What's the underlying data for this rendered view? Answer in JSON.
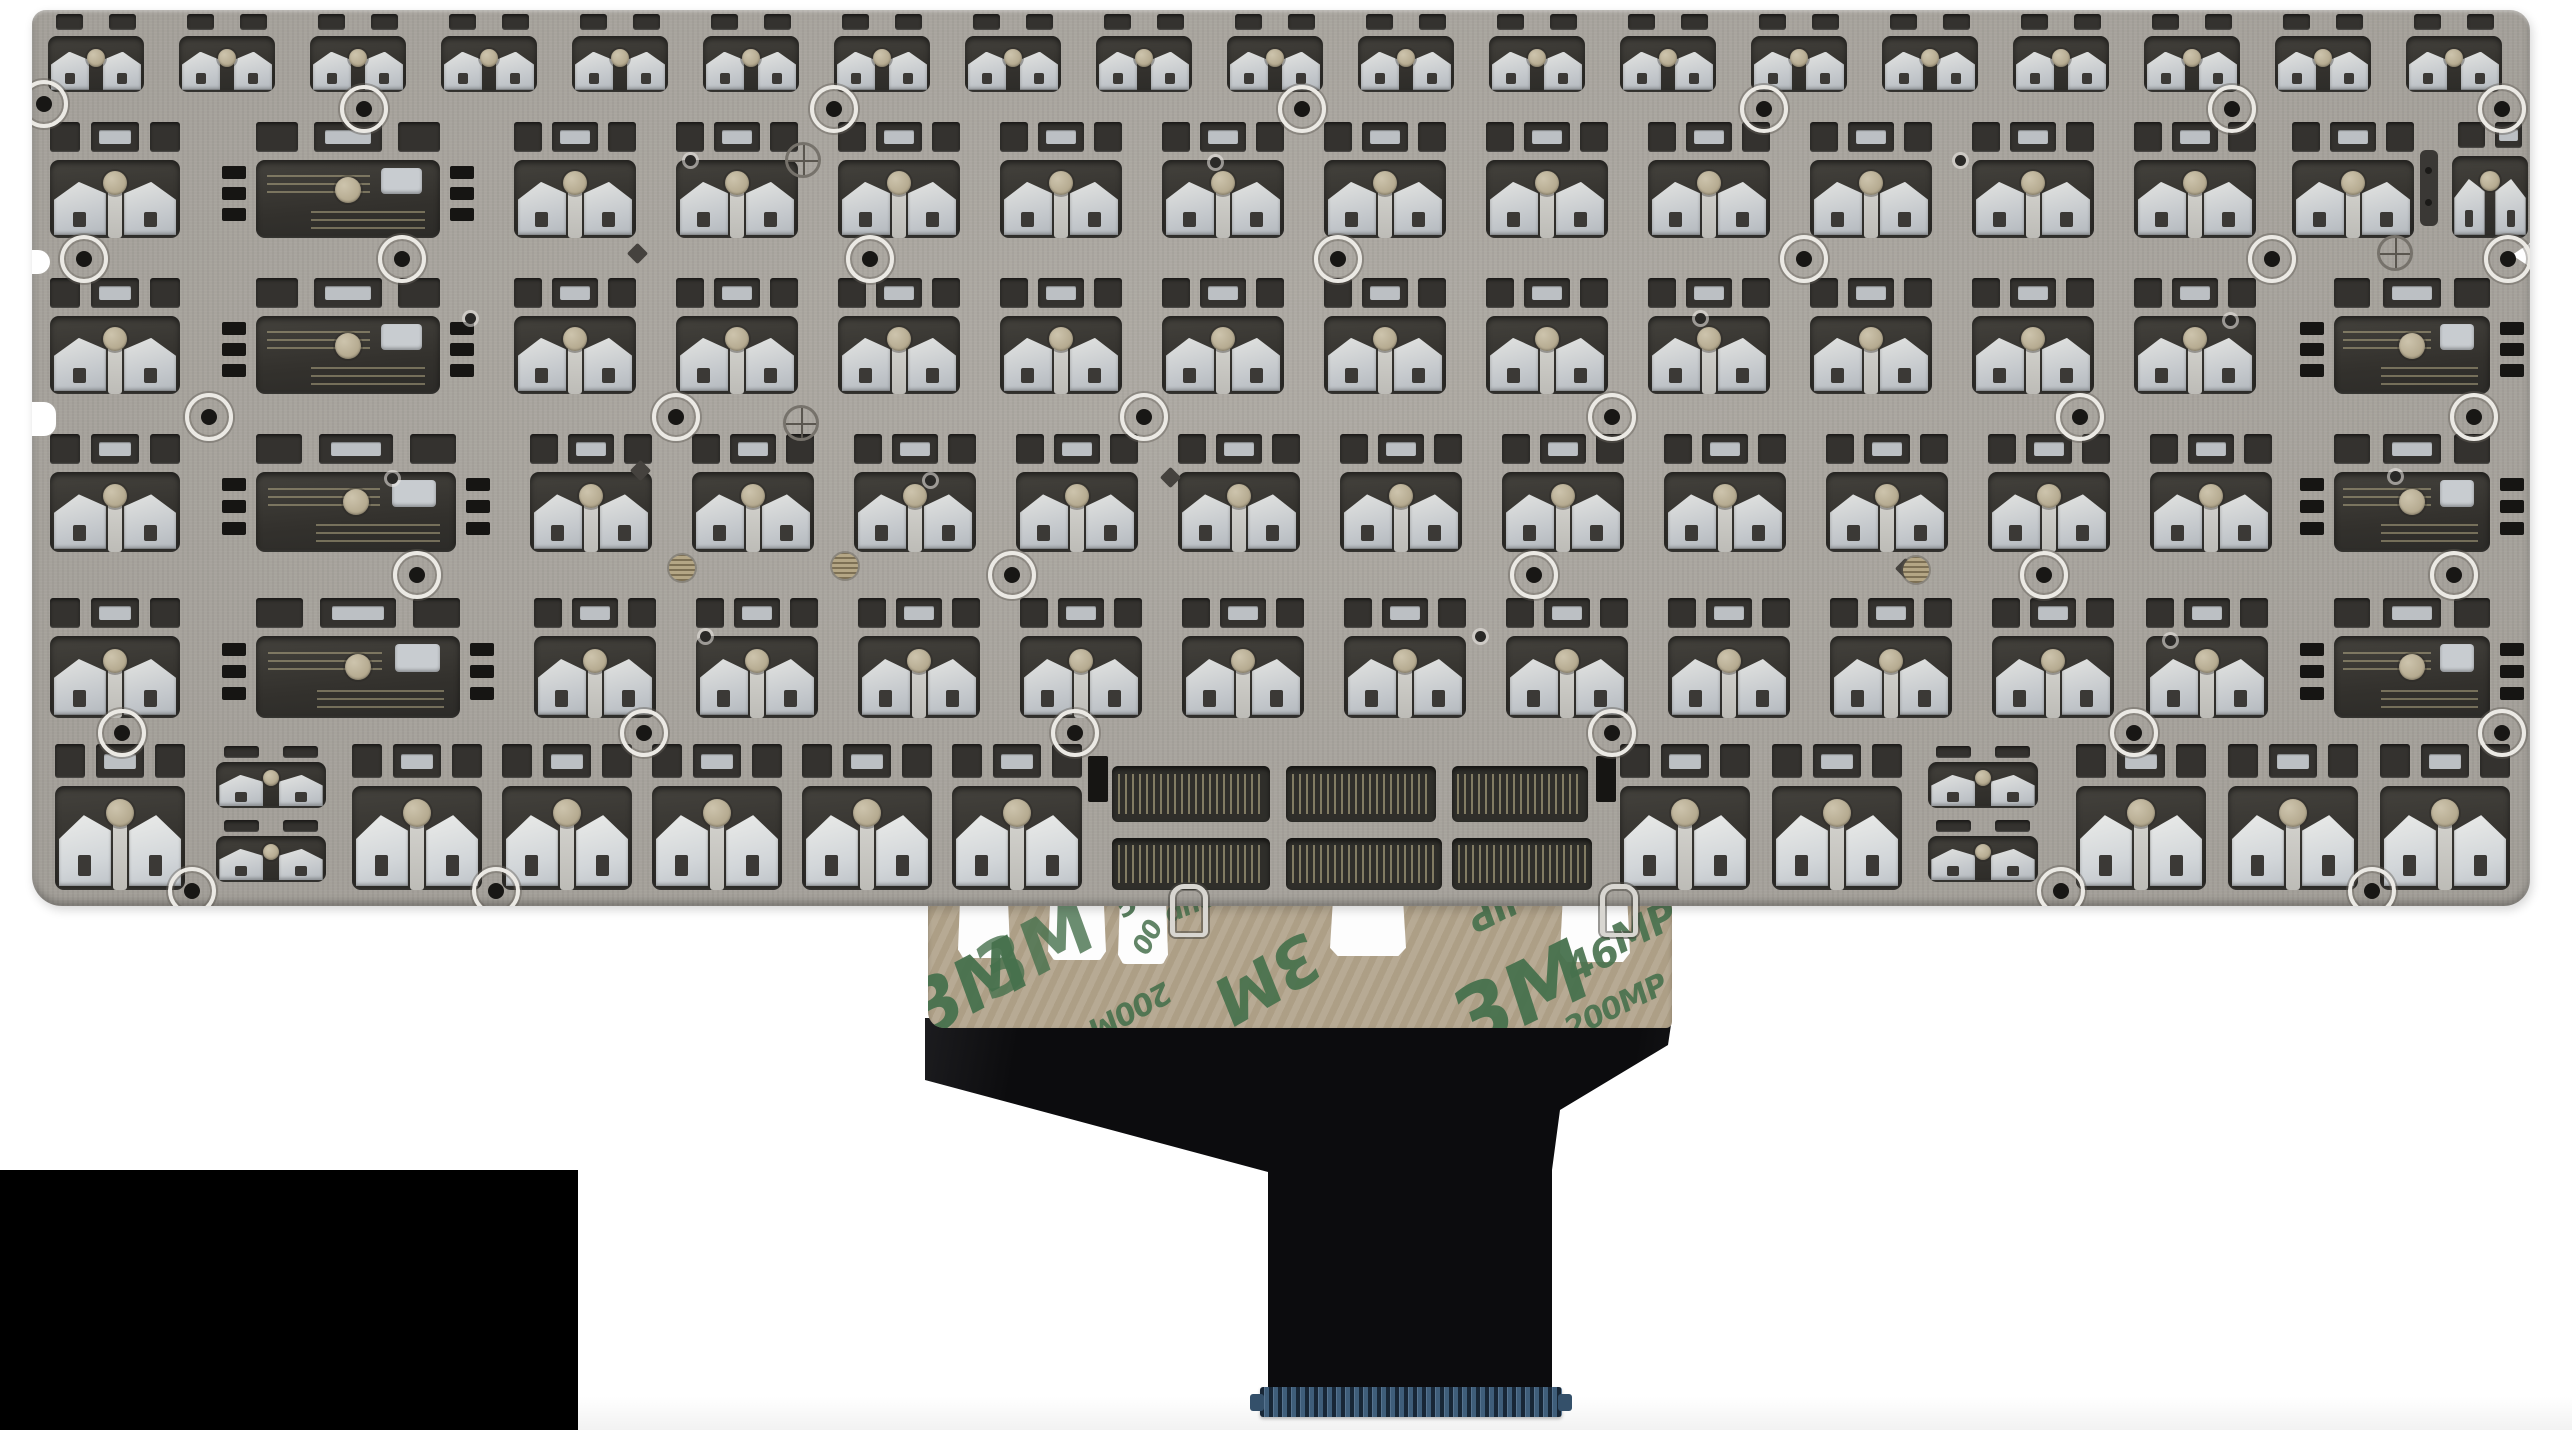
{
  "photo": {
    "canvas": {
      "w": 2572,
      "h": 1430,
      "background": "#ffffff"
    },
    "plate": {
      "x": 32,
      "y": 10,
      "w": 2498,
      "h": 896,
      "radius": "14px 20px 26px 30px",
      "edge_notches": [
        {
          "x": 24,
          "y": 250,
          "w": 26,
          "h": 24
        },
        {
          "x": 24,
          "y": 402,
          "w": 32,
          "h": 34
        }
      ],
      "right_wedge": {
        "x": 2512,
        "y": 243,
        "w": 18,
        "h": 24
      }
    },
    "rows": [
      {
        "y": 14,
        "h": 78,
        "segments": [
          {
            "t": "run",
            "k": "small",
            "x": 48,
            "w": 96,
            "gap": 35,
            "n": 19
          }
        ]
      },
      {
        "y": 122,
        "h": 116,
        "segments": [
          {
            "t": "one",
            "k": "std",
            "x": 50,
            "w": 130
          },
          {
            "t": "one",
            "k": "wide",
            "x": 222,
            "w": 252
          },
          {
            "t": "run",
            "k": "std",
            "x": 514,
            "w": 122,
            "gap": 40,
            "n": 11
          },
          {
            "t": "one",
            "k": "std",
            "x": 2292,
            "w": 122
          },
          {
            "t": "one",
            "k": "bracket",
            "x": 2420,
            "w": 18
          },
          {
            "t": "one",
            "k": "narrow",
            "x": 2452,
            "w": 76
          }
        ]
      },
      {
        "y": 278,
        "h": 116,
        "segments": [
          {
            "t": "one",
            "k": "std",
            "x": 50,
            "w": 130
          },
          {
            "t": "one",
            "k": "wide",
            "x": 222,
            "w": 252
          },
          {
            "t": "run",
            "k": "std",
            "x": 514,
            "w": 122,
            "gap": 40,
            "n": 11
          },
          {
            "t": "one",
            "k": "wide",
            "x": 2300,
            "w": 224
          }
        ]
      },
      {
        "y": 434,
        "h": 118,
        "segments": [
          {
            "t": "one",
            "k": "std",
            "x": 50,
            "w": 130
          },
          {
            "t": "one",
            "k": "wide",
            "x": 222,
            "w": 268
          },
          {
            "t": "run",
            "k": "std",
            "x": 530,
            "w": 122,
            "gap": 40,
            "n": 11
          },
          {
            "t": "one",
            "k": "wide",
            "x": 2300,
            "w": 224
          }
        ]
      },
      {
        "y": 598,
        "h": 120,
        "segments": [
          {
            "t": "one",
            "k": "std",
            "x": 50,
            "w": 130
          },
          {
            "t": "one",
            "k": "wide",
            "x": 222,
            "w": 272
          },
          {
            "t": "run",
            "k": "std",
            "x": 534,
            "w": 122,
            "gap": 40,
            "n": 10
          },
          {
            "t": "one",
            "k": "std",
            "x": 2146,
            "w": 122
          },
          {
            "t": "one",
            "k": "wide",
            "x": 2300,
            "w": 224
          }
        ]
      },
      {
        "y": 744,
        "h": 146,
        "segments": [
          {
            "t": "one",
            "k": "tall",
            "x": 55,
            "w": 130
          },
          {
            "t": "one",
            "k": "stack",
            "x": 212,
            "w": 118
          },
          {
            "t": "run",
            "k": "tall",
            "x": 352,
            "w": 130,
            "gap": 20,
            "n": 5
          },
          {
            "t": "run",
            "k": "tall",
            "x": 1620,
            "w": 130,
            "gap": 22,
            "n": 2
          },
          {
            "t": "one",
            "k": "stack",
            "x": 1924,
            "w": 118
          },
          {
            "t": "run",
            "k": "tall",
            "x": 2076,
            "w": 130,
            "gap": 22,
            "n": 3
          }
        ]
      }
    ],
    "spacebar_windows": [
      [
        1112,
        766,
        158,
        56
      ],
      [
        1286,
        766,
        150,
        56
      ],
      [
        1452,
        766,
        136,
        56
      ],
      [
        1112,
        838,
        158,
        52
      ],
      [
        1286,
        838,
        156,
        52
      ],
      [
        1452,
        838,
        140,
        52
      ]
    ],
    "spacebar_tabs": [
      [
        1088,
        756,
        20,
        46
      ],
      [
        1596,
        756,
        20,
        46
      ]
    ],
    "rivets": [
      [
        40,
        100
      ],
      [
        360,
        105
      ],
      [
        830,
        105
      ],
      [
        1298,
        105
      ],
      [
        1760,
        105
      ],
      [
        2228,
        105
      ],
      [
        2498,
        105
      ],
      [
        80,
        255
      ],
      [
        398,
        255
      ],
      [
        866,
        255
      ],
      [
        1334,
        255
      ],
      [
        1800,
        255
      ],
      [
        2268,
        255
      ],
      [
        2504,
        255
      ],
      [
        205,
        413
      ],
      [
        672,
        413
      ],
      [
        1140,
        413
      ],
      [
        1608,
        413
      ],
      [
        2076,
        413
      ],
      [
        2470,
        413
      ],
      [
        413,
        571
      ],
      [
        1008,
        571
      ],
      [
        1530,
        571
      ],
      [
        2040,
        571
      ],
      [
        2450,
        571
      ],
      [
        118,
        729
      ],
      [
        640,
        729
      ],
      [
        1071,
        729
      ],
      [
        1608,
        729
      ],
      [
        2130,
        729
      ],
      [
        2498,
        729
      ],
      [
        188,
        887
      ],
      [
        492,
        887
      ],
      [
        2057,
        887
      ],
      [
        2368,
        887
      ]
    ],
    "diamonds": [
      [
        637,
        253
      ],
      [
        640,
        470
      ],
      [
        1170,
        477
      ],
      [
        1905,
        568
      ]
    ],
    "targets": [
      [
        800,
        157
      ],
      [
        798,
        420
      ],
      [
        2392,
        250
      ]
    ],
    "brass": [
      [
        682,
        568
      ],
      [
        845,
        566
      ],
      [
        1916,
        570
      ]
    ],
    "dots": [
      [
        690,
        160
      ],
      [
        1215,
        162
      ],
      [
        1960,
        160
      ],
      [
        470,
        318
      ],
      [
        1700,
        318
      ],
      [
        2230,
        320
      ],
      [
        392,
        478
      ],
      [
        930,
        480
      ],
      [
        2395,
        476
      ],
      [
        705,
        636
      ],
      [
        1480,
        636
      ],
      [
        2170,
        640
      ]
    ],
    "ribbon": {
      "x": 925,
      "y": 1018,
      "w": 747,
      "h": 374,
      "color": "#0c0c0e",
      "clip": [
        [
          0,
          0
        ],
        [
          747,
          0
        ],
        [
          743,
          27
        ],
        [
          635,
          92
        ],
        [
          627,
          152
        ],
        [
          627,
          374
        ],
        [
          343,
          374
        ],
        [
          343,
          154
        ],
        [
          0,
          62
        ]
      ]
    },
    "tape": {
      "x": 928,
      "y": 894,
      "w": 744,
      "h": 134,
      "color": "#b2a48c",
      "print_color": "#47714d",
      "slots": [
        [
          958,
          898,
          52,
          60
        ],
        [
          1048,
          898,
          58,
          62
        ],
        [
          1118,
          898,
          50,
          66
        ],
        [
          1330,
          898,
          76,
          58
        ],
        [
          1560,
          898,
          70,
          64
        ]
      ],
      "markings": [
        {
          "text": "3M",
          "x": 968,
          "y": 988,
          "s": 74,
          "r": -28,
          "o": 0.95
        },
        {
          "text": "3M",
          "x": 1034,
          "y": 950,
          "s": 74,
          "r": -28,
          "o": 0.8
        },
        {
          "text": "57",
          "x": 1134,
          "y": 900,
          "s": 30,
          "r": -35,
          "o": 0.9
        },
        {
          "text": "00",
          "x": 1148,
          "y": 938,
          "s": 26,
          "r": -62,
          "o": 0.85
        },
        {
          "text": "dhesi",
          "x": 1200,
          "y": 902,
          "s": 26,
          "r": -22,
          "o": 0.85
        },
        {
          "text": "200M",
          "x": 1130,
          "y": 1010,
          "s": 30,
          "r": 152,
          "o": 0.9
        },
        {
          "text": "3M",
          "x": 1268,
          "y": 978,
          "s": 66,
          "r": 150,
          "o": 0.92
        },
        {
          "text": "3a",
          "x": 1420,
          "y": 890,
          "s": 26,
          "r": -20,
          "o": 0.8
        },
        {
          "text": "dIP",
          "x": 1498,
          "y": 906,
          "s": 36,
          "r": 152,
          "o": 0.9
        },
        {
          "text": "3M",
          "x": 1520,
          "y": 996,
          "s": 84,
          "r": -26,
          "o": 0.95
        },
        {
          "text": "MP",
          "x": 1644,
          "y": 928,
          "s": 40,
          "r": -26,
          "o": 0.9
        },
        {
          "text": "46",
          "x": 1592,
          "y": 960,
          "s": 40,
          "r": -26,
          "o": 0.9
        },
        {
          "text": "200MP A",
          "x": 1630,
          "y": 1000,
          "s": 30,
          "r": -26,
          "o": 0.9
        }
      ]
    },
    "connector": {
      "x": 1260,
      "y": 1387,
      "w": 302,
      "h": 30,
      "color": "#3f5e7a"
    },
    "wire_loops": [
      [
        1170,
        884
      ],
      [
        1600,
        884
      ]
    ],
    "black_box": {
      "x": 0,
      "y": 1170,
      "w": 578,
      "h": 260
    },
    "floor_shadow": {
      "x": 578,
      "y": 1396,
      "w": 1994,
      "h": 34
    }
  },
  "colors": {
    "background": "#ffffff",
    "plate_metal": "#a9a59e",
    "cutout_dark": "#34322f",
    "mechanism_light": "#d7d8d6",
    "pivot_pad": "#b7ad94",
    "tape_kraft": "#b2a48c",
    "tape_print_green": "#47714d",
    "ribbon_black": "#0c0c0e",
    "connector_blue": "#3f5e7a",
    "overlay_black": "#000000"
  }
}
